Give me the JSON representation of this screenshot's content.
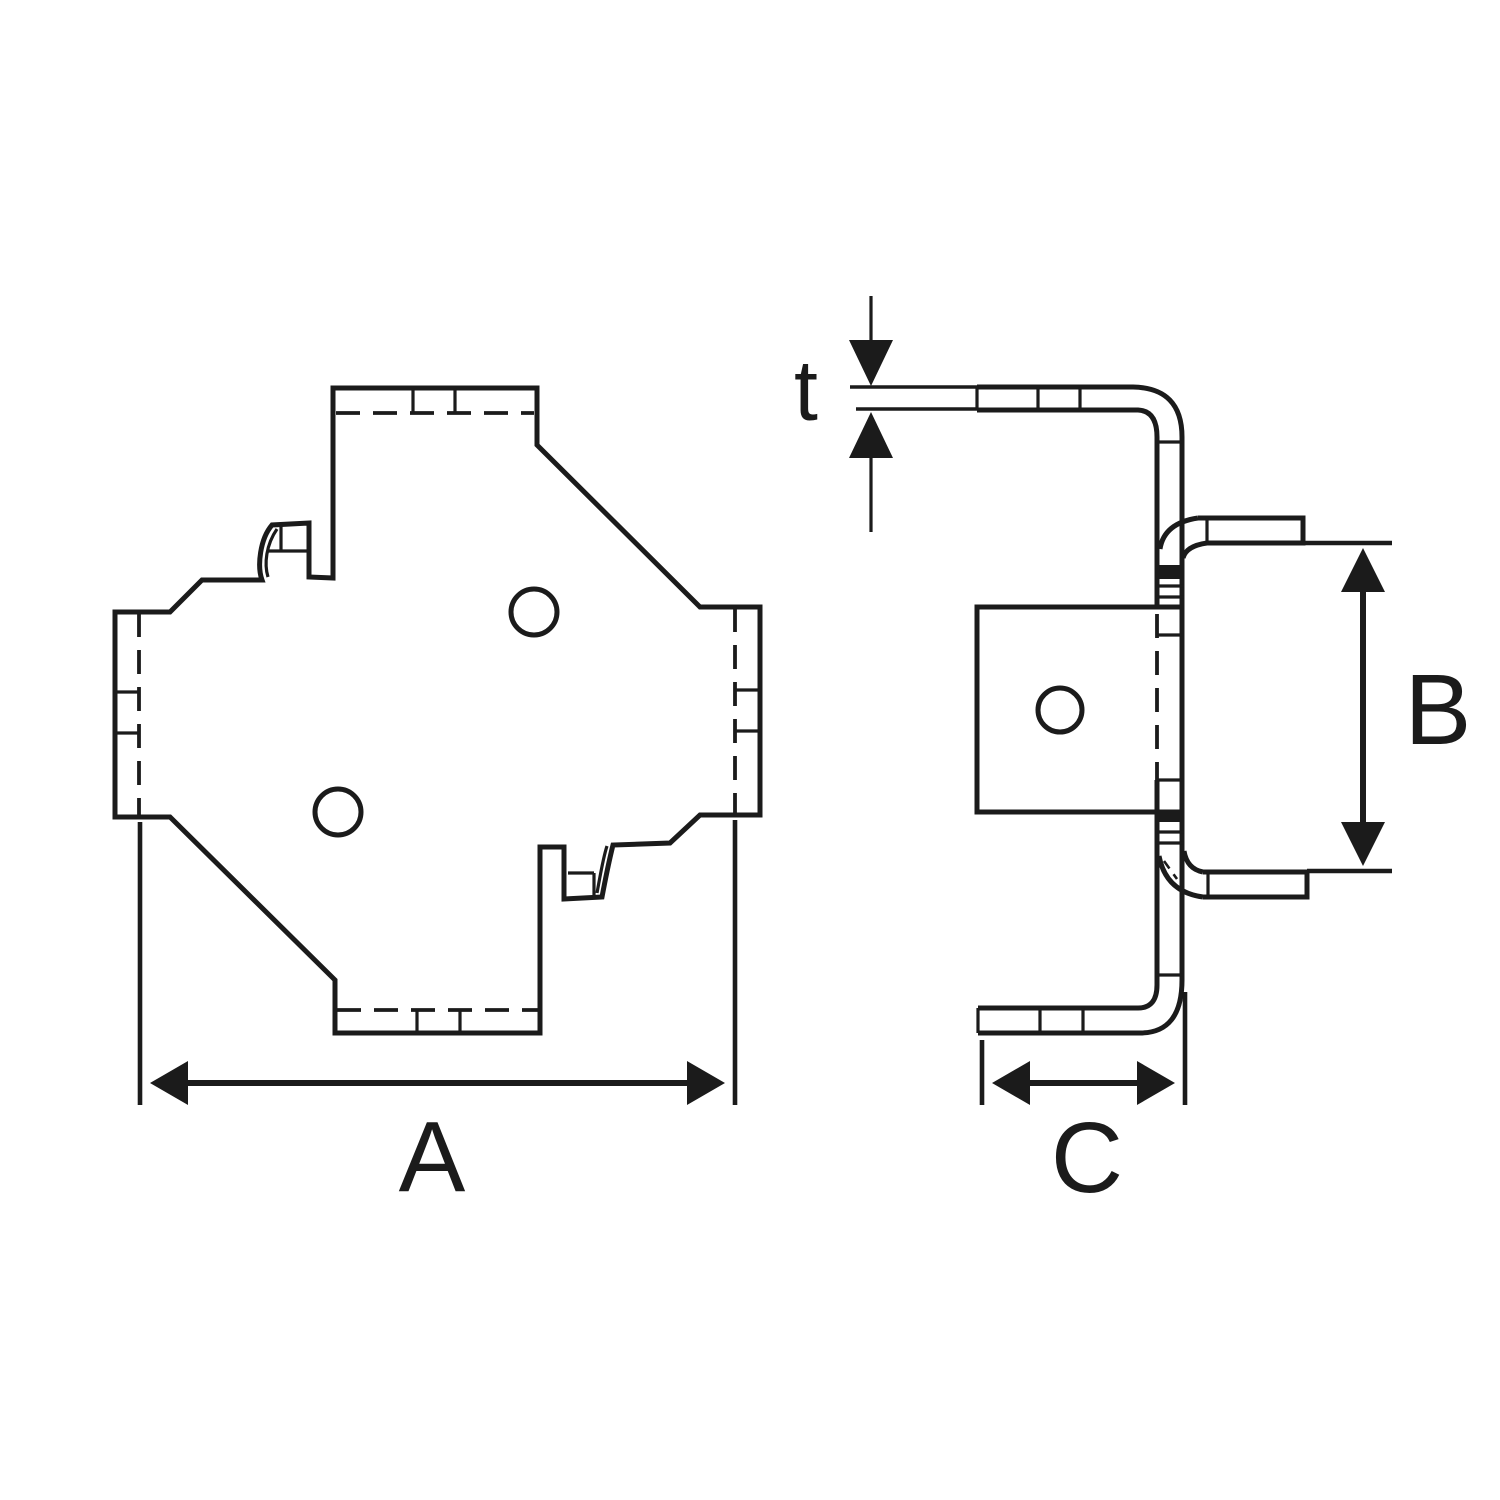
{
  "diagram": {
    "type": "technical-drawing",
    "part": "cross-shaped-terminal-tab",
    "colors": {
      "line": "#1b1b1b",
      "background": "#ffffff"
    },
    "dimensions": {
      "a_label": "A",
      "b_label": "B",
      "c_label": "C",
      "t_label": "t"
    }
  }
}
